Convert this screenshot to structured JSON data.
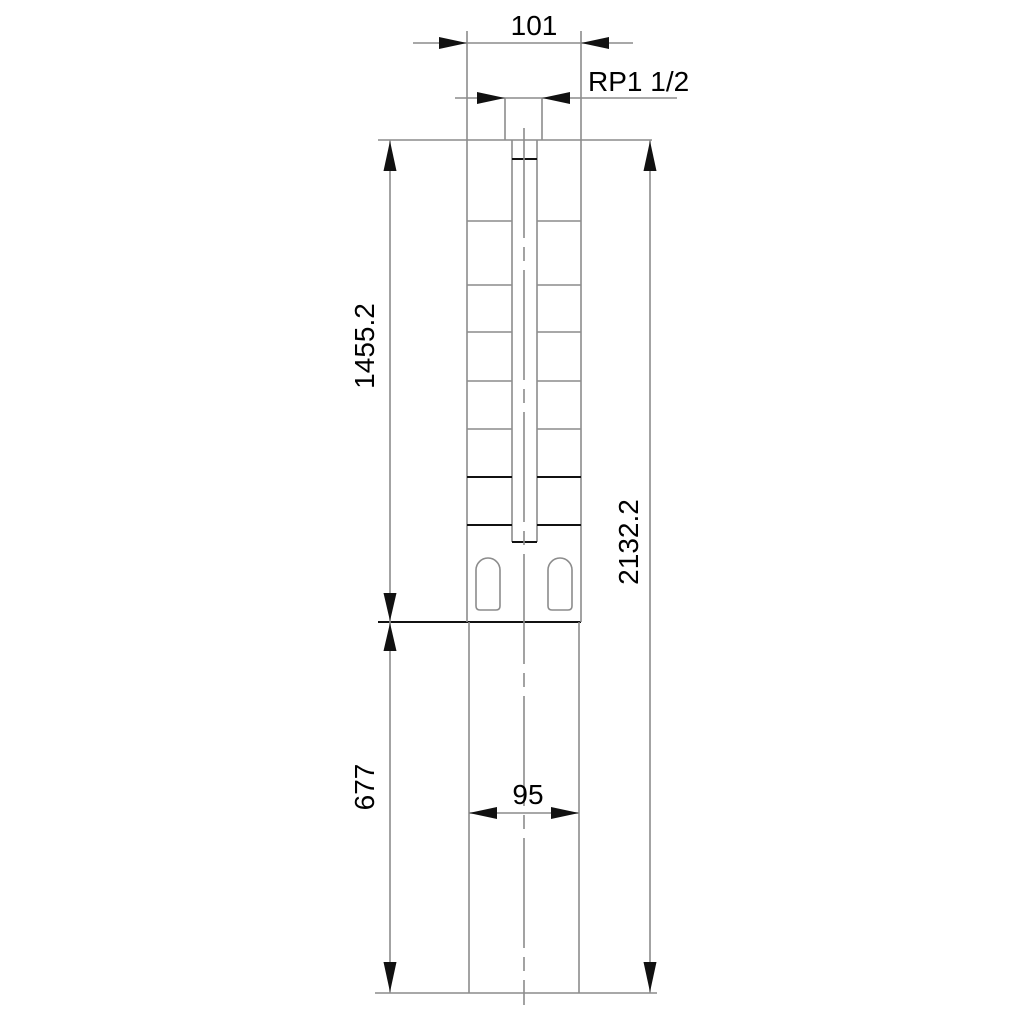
{
  "drawing": {
    "type": "submersible-pump-outline-drawing",
    "labels": {
      "top_width": "101",
      "connection": "RP1 1/2",
      "upper_length": "1455.2",
      "total_length": "2132.2",
      "lower_length": "677",
      "lower_width": "95"
    },
    "colors": {
      "line_gray": "#8c8c8c",
      "line_black": "#111111",
      "background": "#ffffff"
    },
    "stage_lines_gray_y": [
      221,
      285,
      332,
      381,
      429
    ],
    "stage_lines_black_y": [
      477,
      525
    ],
    "stage_span": {
      "left_x1": 467,
      "left_x2": 512,
      "right_x1": 537,
      "right_x2": 581
    },
    "slots": [
      {
        "x": 476
      },
      {
        "x": 548
      }
    ],
    "slot": {
      "y": 558,
      "width": 24,
      "height": 52,
      "top_radius": 12,
      "bottom_radius": 4
    }
  }
}
